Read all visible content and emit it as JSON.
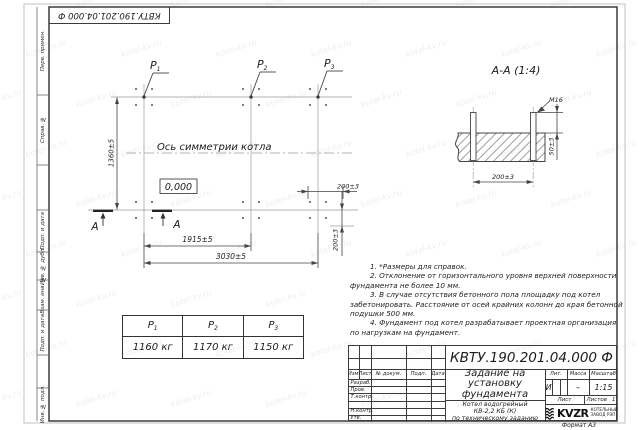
{
  "watermark": {
    "text": "kotel-kv.ru"
  },
  "corner_stamp": {
    "doc_number": "КВТУ.190.201.04.000 Ф"
  },
  "margin": {
    "labels": [
      "Перв. примен.",
      "Справ. №",
      "Подп. и дата",
      "Инв. № дубл.",
      "Взам. инв. №",
      "Подп. и дата",
      "Инв. № подл."
    ]
  },
  "plan": {
    "p_labels": [
      {
        "base": "P",
        "sub": "1"
      },
      {
        "base": "P",
        "sub": "2"
      },
      {
        "base": "P",
        "sub": "3"
      }
    ],
    "symmetry_label": "Ось симметрии котла",
    "elevation": "0,000",
    "dim_height": "1360±5",
    "dim_span_inner": "1915±5",
    "dim_span_total": "3030±5",
    "dim_bolt_offset_h": "200±3",
    "dim_bolt_offset_v": "200±3",
    "section_letter": "А"
  },
  "section_view": {
    "title": "А-А (1:4)",
    "thread_label": "М16",
    "dim_protrusion": "50±3",
    "dim_bolt_spacing": "200±3"
  },
  "loads_table": {
    "columns": [
      {
        "base": "P",
        "sub": "1",
        "value": "1160 кг"
      },
      {
        "base": "P",
        "sub": "2",
        "value": "1170 кг"
      },
      {
        "base": "P",
        "sub": "3",
        "value": "1150 кг"
      }
    ]
  },
  "notes": {
    "lines": [
      "1. *Размеры для справок.",
      "2. Отклонение от горизонтального уровня верхней поверхности",
      "фундамента не более 10 мм.",
      "3. В случае отсутствия бетонного пола площадку под котел",
      "забетонировать. Расстояние от осей крайних колонн до края бетонной",
      "подушки 500 мм.",
      "4. Фундамент под котел разрабатывает проектная организация",
      "по нагрузкам на фундамент."
    ]
  },
  "title_block": {
    "doc_number": "КВТУ.190.201.04.000 Ф",
    "title_lines": [
      "Задание на",
      "установку",
      "фундамента"
    ],
    "product_lines": [
      "Котел водогрейный",
      "КВ-2,2 КБ (К)",
      "по техническому заданию"
    ],
    "grid_headers": [
      "Изм.",
      "Лист",
      "№ докум.",
      "Подп.",
      "Дата"
    ],
    "grid_rows": [
      "Разраб.",
      "Пров.",
      "Т.контр.",
      "",
      "Н.контр.",
      "Утв."
    ],
    "lit_header": "Лит.",
    "mass_header": "Масса",
    "scale_header": "Масштаб",
    "lit_value": "И",
    "mass_value": "–",
    "scale_value": "1:15",
    "sheet_label": "Лист",
    "sheets_label": "Листов",
    "sheets_value": "1",
    "logo_text": "KVZR",
    "logo_caption_lines": [
      "КОТЕЛЬНЫЙ",
      "ЗАВОД РЭП"
    ],
    "format_label": "Формат А3"
  }
}
